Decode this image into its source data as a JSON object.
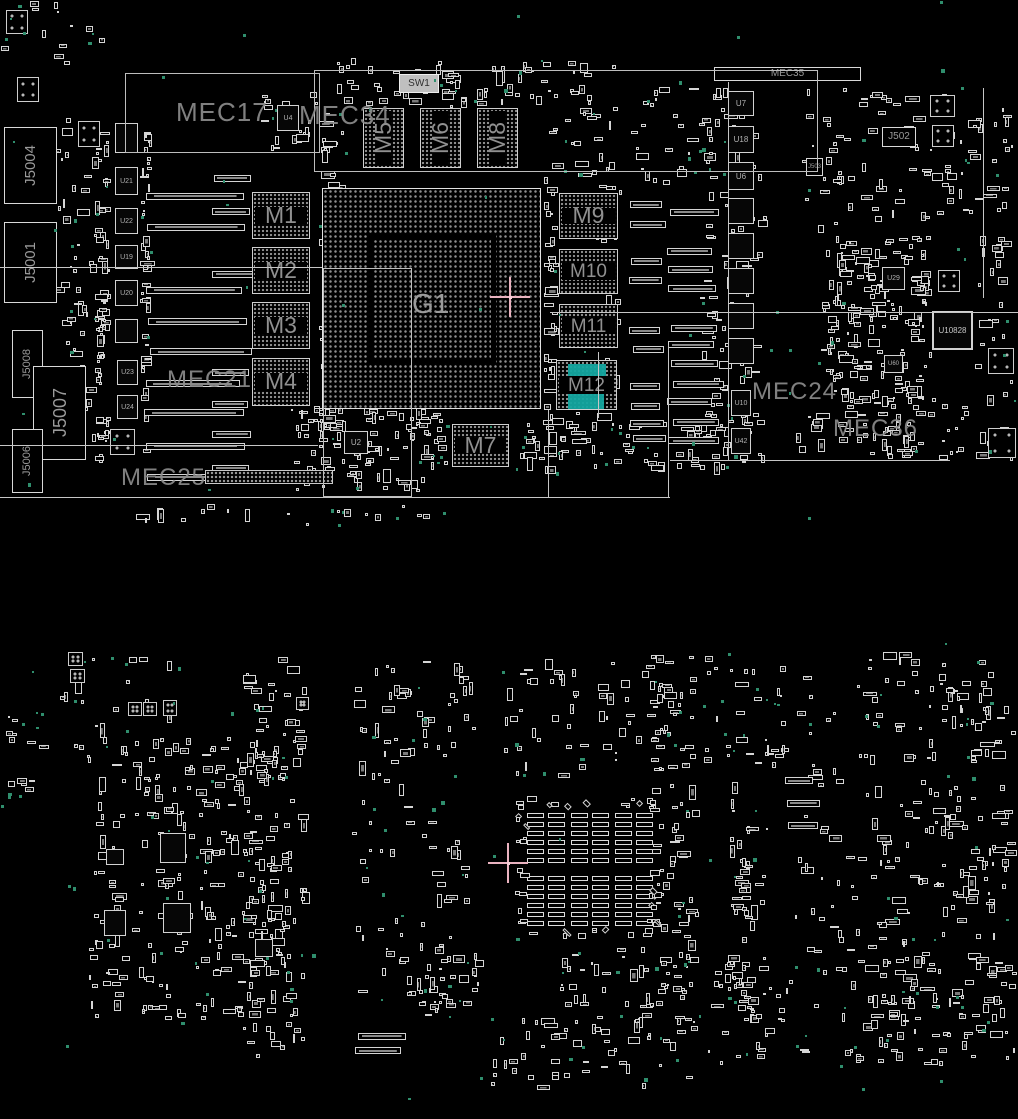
{
  "meta": {
    "description": "PCB boardview placement diagram, top and bottom board views on black background"
  },
  "colors": {
    "background": "#000000",
    "outline": "#d5d5d5",
    "label_grey": "#8b8b8b",
    "highlight_teal": "#14a6a0",
    "testpoint_teal": "#2f8e6d",
    "crosshair_pink": "#eab3c0"
  },
  "selection": {
    "component": "M12",
    "color": "#14a6a0"
  },
  "top_view": {
    "bounds": [
      0,
      0,
      1018,
      530
    ],
    "region_labels": [
      {
        "t": "MEC17",
        "x": 176,
        "y": 99,
        "fs": 26
      },
      {
        "t": "MEC34",
        "x": 299,
        "y": 102,
        "fs": 26
      },
      {
        "t": "MEC21",
        "x": 167,
        "y": 368,
        "fs": 24
      },
      {
        "t": "MEC25",
        "x": 121,
        "y": 466,
        "fs": 24
      },
      {
        "t": "MEC24",
        "x": 752,
        "y": 380,
        "fs": 24
      },
      {
        "t": "MEC36",
        "x": 833,
        "y": 417,
        "fs": 24
      }
    ],
    "memory_components": [
      {
        "id": "M1",
        "r": [
          252,
          192,
          58,
          47
        ],
        "o": "h"
      },
      {
        "id": "M2",
        "r": [
          252,
          247,
          58,
          47
        ],
        "o": "h"
      },
      {
        "id": "M3",
        "r": [
          252,
          302,
          58,
          47
        ],
        "o": "h"
      },
      {
        "id": "M4",
        "r": [
          252,
          358,
          58,
          48
        ],
        "o": "h"
      },
      {
        "id": "M5",
        "r": [
          363,
          108,
          41,
          60
        ],
        "o": "v"
      },
      {
        "id": "M6",
        "r": [
          420,
          108,
          41,
          60
        ],
        "o": "v"
      },
      {
        "id": "M8",
        "r": [
          477,
          108,
          41,
          60
        ],
        "o": "v"
      },
      {
        "id": "M7",
        "r": [
          452,
          424,
          57,
          43
        ],
        "o": "h"
      },
      {
        "id": "M9",
        "r": [
          559,
          193,
          59,
          46
        ],
        "o": "h"
      },
      {
        "id": "M10",
        "r": [
          559,
          249,
          59,
          45
        ],
        "o": "h"
      },
      {
        "id": "M11",
        "r": [
          559,
          304,
          59,
          44
        ],
        "o": "h"
      },
      {
        "id": "M12",
        "r": [
          556,
          360,
          61,
          50
        ],
        "o": "h",
        "selected": true,
        "highlights": [
          [
            11,
            3,
            38,
            13
          ],
          [
            11,
            32,
            36,
            16
          ]
        ]
      }
    ],
    "gpu_component": {
      "id": "G1",
      "r": [
        322,
        188,
        219,
        221
      ]
    },
    "connectors": [
      {
        "id": "J5004",
        "r": [
          4,
          127,
          53,
          77
        ],
        "rot": true,
        "fs": 15
      },
      {
        "id": "J5001",
        "r": [
          4,
          222,
          53,
          81
        ],
        "rot": true,
        "fs": 15
      },
      {
        "id": "J5008",
        "r": [
          12,
          330,
          31,
          68
        ],
        "rot": true,
        "fs": 11
      },
      {
        "id": "J5007",
        "r": [
          33,
          366,
          53,
          94
        ],
        "rot": true,
        "fs": 18
      },
      {
        "id": "J5006",
        "r": [
          12,
          429,
          31,
          64
        ],
        "rot": true,
        "fs": 11
      },
      {
        "id": "J502",
        "r": [
          882,
          127,
          34,
          20
        ],
        "rot": false,
        "fs": 10
      },
      {
        "id": "J503",
        "r": [
          806,
          158,
          17,
          18
        ],
        "rot": false,
        "fs": 6
      },
      {
        "id": "MEC35",
        "r": [
          714,
          67,
          147,
          14
        ],
        "rot": false,
        "fs": 10
      }
    ],
    "ics": [
      {
        "id": "SW1",
        "r": [
          399,
          74,
          40,
          19
        ],
        "fs": 10,
        "light": true
      },
      {
        "id": "U4",
        "r": [
          277,
          105,
          22,
          26
        ],
        "fs": 7
      },
      {
        "id": "U2",
        "r": [
          344,
          431,
          24,
          23
        ],
        "fs": 8
      },
      {
        "id": "",
        "r": [
          115,
          123,
          23,
          30
        ]
      },
      {
        "id": "U21",
        "r": [
          115,
          167,
          23,
          28
        ],
        "fs": 7
      },
      {
        "id": "U22",
        "r": [
          115,
          208,
          23,
          26
        ],
        "fs": 7
      },
      {
        "id": "U19",
        "r": [
          115,
          245,
          23,
          24
        ],
        "fs": 7
      },
      {
        "id": "U20",
        "r": [
          115,
          280,
          23,
          26
        ],
        "fs": 7
      },
      {
        "id": "",
        "r": [
          115,
          319,
          23,
          24
        ]
      },
      {
        "id": "U23",
        "r": [
          117,
          360,
          21,
          25
        ],
        "fs": 7
      },
      {
        "id": "U24",
        "r": [
          117,
          395,
          21,
          24
        ],
        "fs": 7
      },
      {
        "id": "U7",
        "r": [
          728,
          91,
          26,
          25
        ],
        "fs": 8
      },
      {
        "id": "U18",
        "r": [
          728,
          126,
          26,
          27
        ],
        "fs": 8
      },
      {
        "id": "U6",
        "r": [
          728,
          162,
          26,
          28
        ],
        "fs": 8
      },
      {
        "id": "",
        "r": [
          728,
          198,
          26,
          26
        ]
      },
      {
        "id": "",
        "r": [
          728,
          233,
          26,
          26
        ]
      },
      {
        "id": "",
        "r": [
          728,
          268,
          26,
          26
        ]
      },
      {
        "id": "",
        "r": [
          728,
          303,
          26,
          26
        ]
      },
      {
        "id": "",
        "r": [
          728,
          338,
          26,
          26
        ]
      },
      {
        "id": "U10",
        "r": [
          731,
          390,
          20,
          26
        ],
        "fs": 7
      },
      {
        "id": "U42",
        "r": [
          731,
          428,
          20,
          26
        ],
        "fs": 7
      },
      {
        "id": "U29",
        "r": [
          882,
          267,
          23,
          23
        ],
        "fs": 7
      },
      {
        "id": "U60",
        "r": [
          884,
          355,
          19,
          18
        ],
        "fs": 6
      },
      {
        "id": "U10828",
        "r": [
          932,
          311,
          41,
          39
        ],
        "fs": 8,
        "big": true
      }
    ],
    "fiducials": [
      [
        6,
        10,
        22,
        24
      ],
      [
        17,
        77,
        22,
        25
      ],
      [
        78,
        121,
        22,
        26
      ],
      [
        110,
        429,
        25,
        26
      ],
      [
        930,
        95,
        25,
        22
      ],
      [
        932,
        125,
        22,
        22
      ],
      [
        938,
        270,
        22,
        22
      ],
      [
        988,
        348,
        26,
        26
      ],
      [
        988,
        428,
        28,
        30
      ]
    ],
    "outlines": [
      {
        "r": [
          125,
          73,
          195,
          80
        ],
        "t": "rect"
      },
      {
        "r": [
          314,
          70,
          504,
          102
        ],
        "t": "rect"
      },
      {
        "r": [
          323,
          268,
          89,
          229
        ],
        "t": "rect"
      },
      {
        "r": [
          0,
          267,
          322,
          0
        ]
      },
      {
        "r": [
          550,
          312,
          468,
          0
        ]
      },
      {
        "r": [
          0,
          445,
          318,
          0
        ]
      },
      {
        "r": [
          0,
          497,
          670,
          0
        ]
      },
      {
        "r": [
          668,
          345,
          0,
          152
        ]
      },
      {
        "r": [
          728,
          82,
          0,
          378
        ]
      },
      {
        "r": [
          670,
          460,
          280,
          0
        ]
      },
      {
        "r": [
          983,
          88,
          0,
          210
        ]
      },
      {
        "r": [
          598,
          352,
          0,
          66
        ]
      },
      {
        "r": [
          548,
          410,
          0,
          87
        ]
      }
    ],
    "pad_bar_columns": [
      {
        "x": 147,
        "y": 163,
        "w": 98,
        "rows": 11,
        "step": 31
      },
      {
        "x": 213,
        "y": 176,
        "w": 40,
        "rows": 10,
        "step": 32
      },
      {
        "x": 630,
        "y": 203,
        "w": 32,
        "rows": 15,
        "step": 18
      },
      {
        "x": 670,
        "y": 210,
        "w": 48,
        "rows": 13,
        "step": 19
      }
    ],
    "dot_strips": [
      [
        205,
        470,
        128,
        14
      ]
    ],
    "scatter_clusters": [
      [
        95,
        125,
        16,
        340,
        55
      ],
      [
        140,
        130,
        12,
        330,
        40
      ],
      [
        318,
        112,
        28,
        360,
        70
      ],
      [
        543,
        165,
        16,
        310,
        40
      ],
      [
        258,
        86,
        62,
        66,
        22
      ],
      [
        336,
        58,
        126,
        48,
        28
      ],
      [
        440,
        58,
        120,
        52,
        30
      ],
      [
        548,
        60,
        70,
        125,
        30
      ],
      [
        630,
        80,
        95,
        108,
        30
      ],
      [
        700,
        85,
        70,
        385,
        95
      ],
      [
        795,
        88,
        165,
        145,
        70
      ],
      [
        820,
        235,
        112,
        175,
        185
      ],
      [
        795,
        398,
        175,
        62,
        60
      ],
      [
        955,
        85,
        60,
        130,
        25
      ],
      [
        975,
        230,
        43,
        240,
        30
      ],
      [
        413,
        412,
        38,
        58,
        15
      ],
      [
        515,
        412,
        92,
        60,
        30
      ],
      [
        620,
        413,
        112,
        62,
        35
      ],
      [
        290,
        406,
        145,
        88,
        80
      ],
      [
        60,
        300,
        45,
        160,
        30
      ],
      [
        0,
        0,
        120,
        70,
        12
      ],
      [
        44,
        108,
        58,
        210,
        30
      ],
      [
        595,
        180,
        30,
        290,
        25
      ],
      [
        130,
        503,
        300,
        26,
        18
      ]
    ],
    "teal_count": 115,
    "crosshair": {
      "x": 510,
      "y": 297,
      "arm": 20
    }
  },
  "bottom_view": {
    "bounds": [
      0,
      640,
      1018,
      460
    ],
    "cap_field": {
      "x": 516,
      "y": 797,
      "w": 140,
      "h": 137,
      "gx": 11,
      "gy": 16,
      "dx": 44,
      "dy": 63,
      "bw": 17,
      "bh": 5,
      "brows": 6,
      "bcols": 2,
      "ring_n": 56
    },
    "ics": [
      {
        "id": "",
        "r": [
          160,
          833,
          26,
          30
        ]
      },
      {
        "id": "",
        "r": [
          163,
          903,
          28,
          30
        ]
      },
      {
        "id": "",
        "r": [
          104,
          910,
          22,
          26
        ]
      },
      {
        "id": "",
        "r": [
          106,
          849,
          18,
          16
        ]
      },
      {
        "id": "",
        "r": [
          255,
          939,
          18,
          18
        ]
      }
    ],
    "fiducials": [
      [
        68,
        652,
        15,
        14
      ],
      [
        70,
        669,
        15,
        14
      ],
      [
        128,
        702,
        14,
        14
      ],
      [
        143,
        702,
        14,
        14
      ],
      [
        163,
        700,
        14,
        16
      ],
      [
        296,
        697,
        13,
        13
      ]
    ],
    "pad_bar_columns": [
      {
        "x": 358,
        "y": 1014,
        "w": 48,
        "rows": 3,
        "step": 17
      },
      {
        "x": 786,
        "y": 778,
        "w": 30,
        "rows": 3,
        "step": 23
      }
    ],
    "scatter_clusters": [
      [
        55,
        642,
        125,
        118,
        20
      ],
      [
        88,
        735,
        205,
        285,
        230
      ],
      [
        242,
        652,
        68,
        300,
        85
      ],
      [
        242,
        952,
        68,
        112,
        30
      ],
      [
        352,
        658,
        125,
        118,
        45
      ],
      [
        352,
        772,
        125,
        240,
        55
      ],
      [
        395,
        955,
        90,
        68,
        25
      ],
      [
        498,
        658,
        185,
        122,
        60
      ],
      [
        560,
        945,
        135,
        75,
        35
      ],
      [
        478,
        1013,
        230,
        78,
        55
      ],
      [
        648,
        655,
        50,
        122,
        25
      ],
      [
        652,
        780,
        48,
        230,
        45
      ],
      [
        700,
        648,
        90,
        130,
        30
      ],
      [
        728,
        778,
        45,
        240,
        50
      ],
      [
        795,
        665,
        75,
        350,
        45
      ],
      [
        862,
        648,
        148,
        122,
        50
      ],
      [
        868,
        778,
        142,
        290,
        110
      ],
      [
        700,
        958,
        115,
        108,
        35
      ],
      [
        838,
        958,
        100,
        108,
        35
      ],
      [
        940,
        680,
        78,
        380,
        60
      ],
      [
        0,
        700,
        50,
        120,
        12
      ]
    ],
    "teal_count": 150,
    "crosshair": {
      "x": 508,
      "y": 863,
      "arm": 20
    }
  }
}
